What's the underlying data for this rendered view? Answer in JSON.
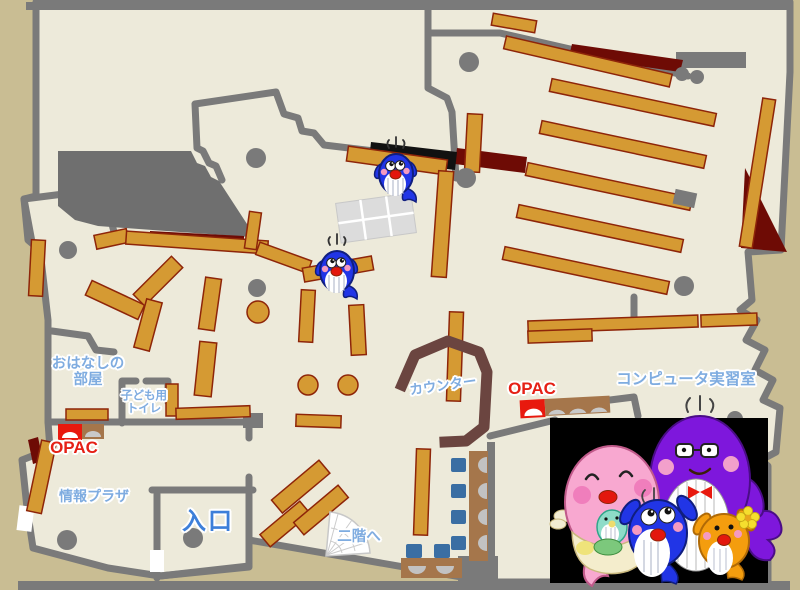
{
  "labels": {
    "ohanashi_room": {
      "line1": "おはなしの",
      "line2": "部屋"
    },
    "kids_toilet": {
      "line1": "子ども用",
      "line2": "トイレ"
    },
    "opac_left": "OPAC",
    "opac_right": "OPAC",
    "info_plaza": "情報プラザ",
    "entrance": "入口",
    "counter": "カウンター",
    "computer_room": "コンピュータ実習室",
    "to_second_floor": "二階へ"
  },
  "colors": {
    "background": "#C9BD93",
    "floor": "#EDEADA",
    "wall": "#7A7A7A",
    "bookshelf": "#D59A33",
    "bookshelf_border": "#8E2509",
    "accent_dark_red": "#6E0B05",
    "counter_brown": "#6B4540",
    "desk_brown": "#A5764B",
    "chair_blue": "#3A6EA3",
    "room_label_blue": "#7FACE0",
    "entrance_label_blue": "#3D7FD9",
    "opac_label_red": "#E52015",
    "mascot_blue": "#2135E6",
    "mascot_pink": "#F8A8D0",
    "mascot_purple": "#7E17DC",
    "mascot_orange": "#F49D0E"
  },
  "mascots": {
    "small_whale_count": 2,
    "family_members": [
      "pink-mother-whale",
      "purple-father-whale",
      "blue-child-whale",
      "orange-child-whale"
    ]
  }
}
